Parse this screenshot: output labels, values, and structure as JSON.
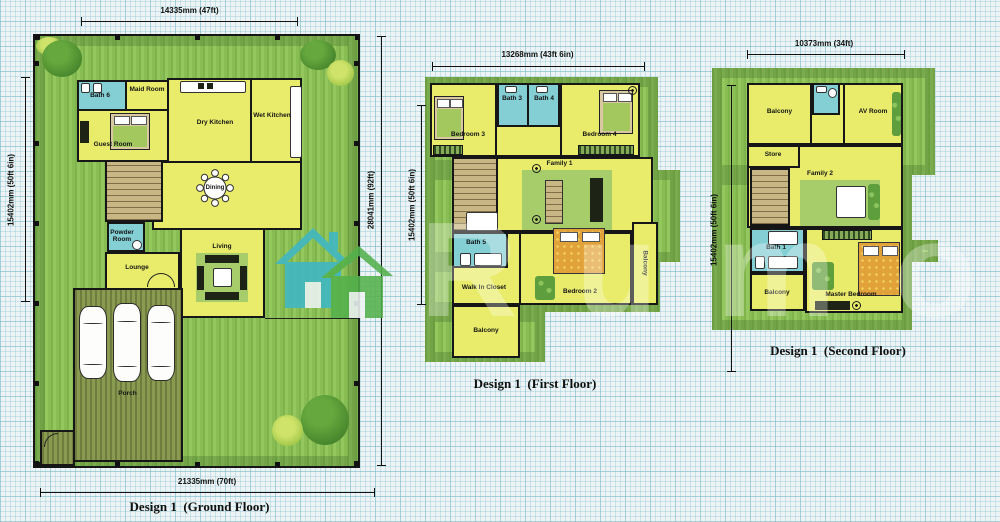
{
  "watermark": {
    "text": "Rumo"
  },
  "colors": {
    "paper": "#eef4f5",
    "grid": "#7cbecc",
    "lawn": "#8abf55",
    "room_yellow": "#e9ec6b",
    "bath_cyan": "#84cfd4",
    "porch_olive": "#7d8a45",
    "bed_orange": "#e2a23a",
    "watermark_teal": "#3fb7c6",
    "watermark_green": "#54b14c"
  },
  "ground": {
    "caption": "Design 1  (Ground Floor)",
    "dims": {
      "top": "14335mm (47ft)",
      "left": "15402mm (50ft 6in)",
      "right": "28041mm (92ft)",
      "bottom": "21335mm (70ft)"
    },
    "rooms": {
      "bath6": "Bath 6",
      "maid": "Maid Room",
      "guest": "Guest Room",
      "dry_kitchen": "Dry Kitchen",
      "wet_kitchen": "Wet Kitchen",
      "dining": "Dining",
      "powder": "Powder Room",
      "lounge": "Lounge",
      "living": "Living",
      "porch": "Porch"
    }
  },
  "first": {
    "caption": "Design 1  (First Floor)",
    "dims": {
      "top": "13268mm (43ft 6in)",
      "left": "15402mm (50ft 6in)"
    },
    "rooms": {
      "bedroom3": "Bedroom 3",
      "bath3": "Bath 3",
      "bath4": "Bath 4",
      "bedroom4": "Bedroom 4",
      "family1": "Family 1",
      "bath5": "Bath 5",
      "walk_in_closet": "Walk In Closet",
      "bedroom2": "Bedroom 2",
      "balcony_right": "Balcony",
      "balcony_bottom": "Balcony"
    }
  },
  "second": {
    "caption": "Design 1  (Second Floor)",
    "dims": {
      "top": "10373mm (34ft)",
      "left": "15402mm (50ft 6in)"
    },
    "rooms": {
      "balcony_top": "Balcony",
      "av_room": "AV Room",
      "store": "Store",
      "family2": "Family 2",
      "bath1": "Bath 1",
      "balcony_bottom": "Balcony",
      "master": "Master Bedroom"
    }
  }
}
